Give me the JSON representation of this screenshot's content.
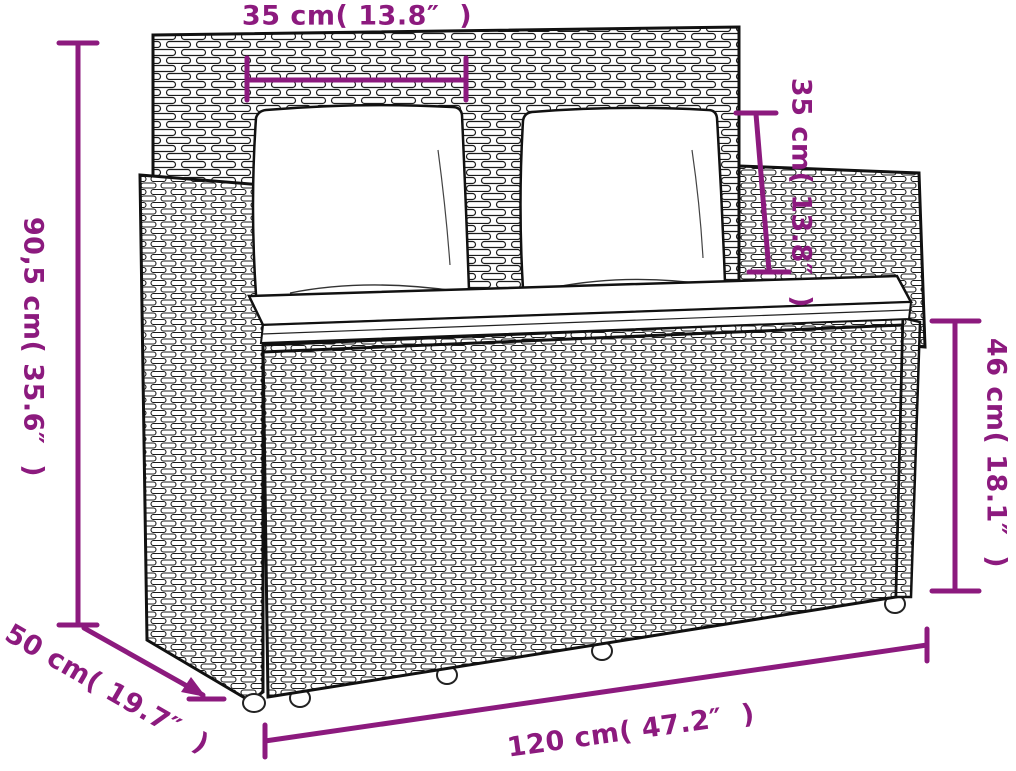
{
  "diagram": {
    "title": "Poly rattan garden bench with cushions - dimension drawing",
    "accent_color": "#8c1a7e",
    "line_color": "#1a1a1a",
    "background": "#ffffff",
    "parts": [
      "backrest-panel",
      "left-armrest-panel",
      "right-armrest-panel",
      "left-back-pillow",
      "right-back-pillow",
      "seat-cushion",
      "seat-box",
      "feet"
    ]
  },
  "dimensions": {
    "top": {
      "label": "35 cm( 13.8″  )",
      "cm": "35",
      "inch": "13.8"
    },
    "left": {
      "label": "90,5 cm( 35.6″  )",
      "cm": "90,5",
      "inch": "35.6"
    },
    "right_back": {
      "label": "35 cm( 13.8″  )",
      "cm": "35",
      "inch": "13.8"
    },
    "right_seat": {
      "label": "46 cm( 18.1″  )",
      "cm": "46",
      "inch": "18.1"
    },
    "depth": {
      "label": "50 cm( 19.7″  )",
      "cm": "50",
      "inch": "19.7"
    },
    "bottom": {
      "label": "120 cm( 47.2″  )",
      "cm": "120",
      "inch": "47.2"
    }
  }
}
